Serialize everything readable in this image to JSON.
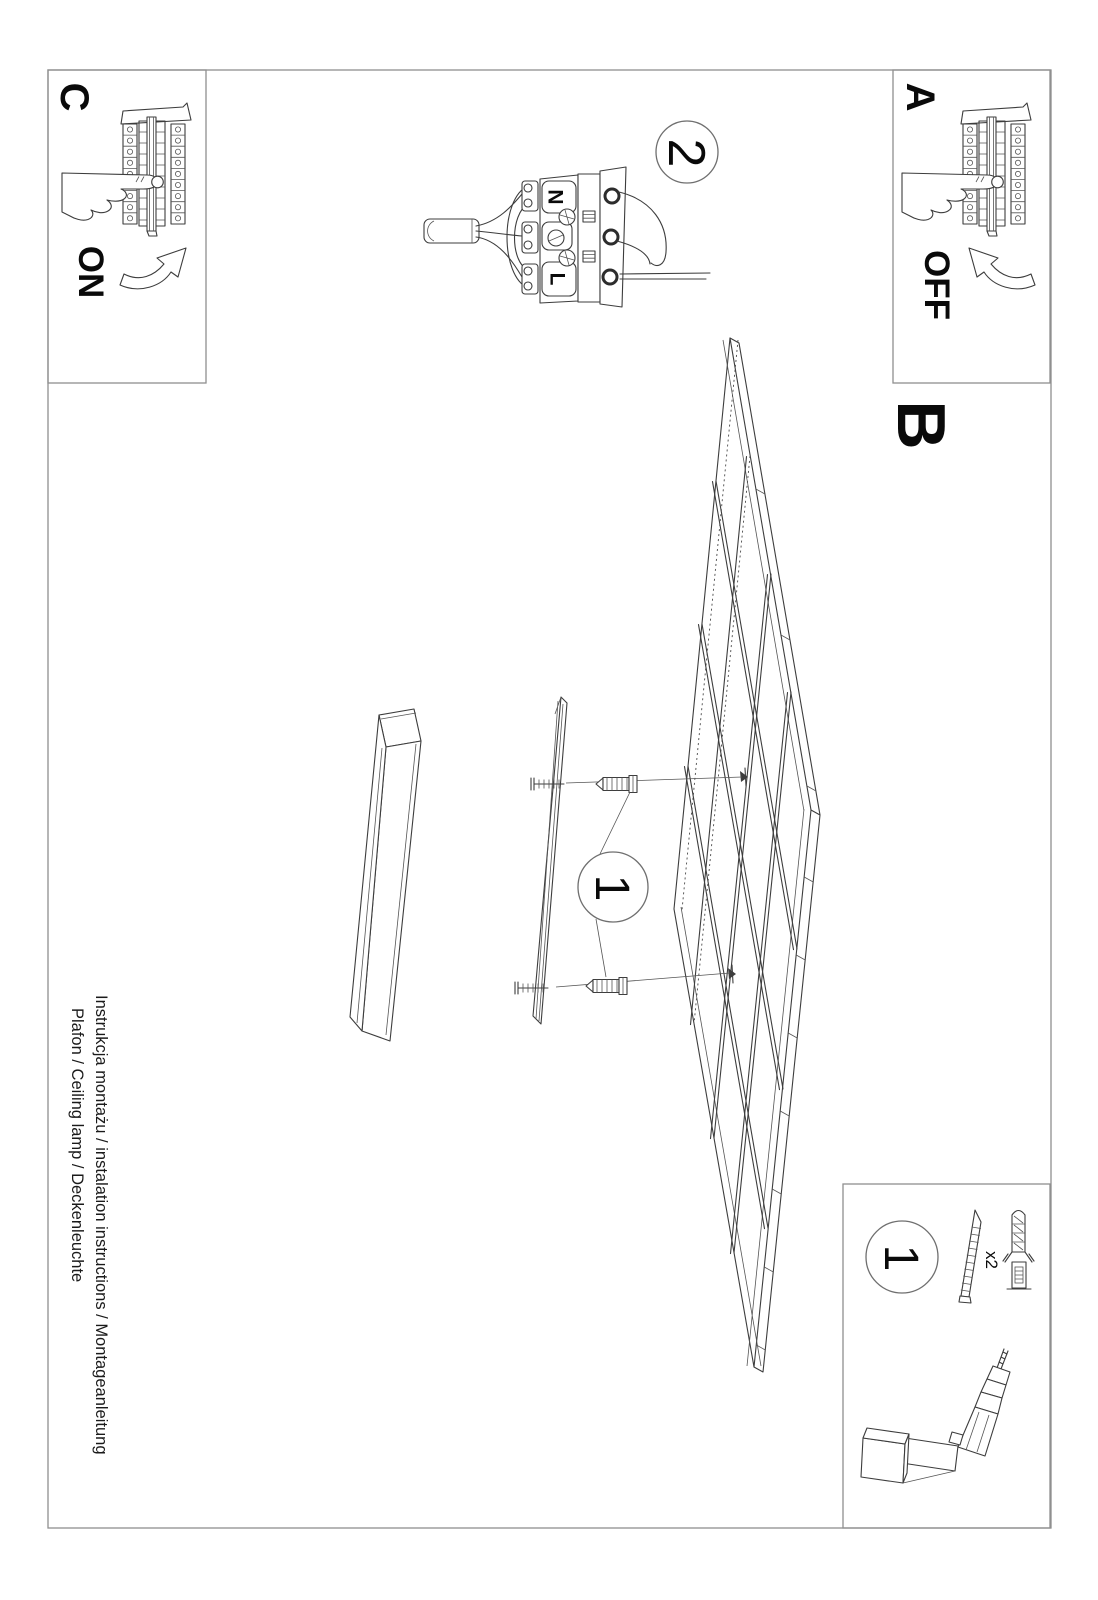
{
  "page": {
    "title_line": "Instrukcja montażu / instalation instructions / Montageanleitung",
    "product_line": "Plafon / Ceiling lamp / Deckenleuchte"
  },
  "panels": {
    "a": {
      "label": "A",
      "action": "OFF"
    },
    "b": {
      "label": "B"
    },
    "c": {
      "label": "C",
      "action": "ON"
    }
  },
  "step1": {
    "badge": "1"
  },
  "step2": {
    "badge": "2",
    "terminal_top": "N",
    "terminal_bottom": "L"
  },
  "toolbox": {
    "badge": "1",
    "quantity": "x2"
  },
  "colors": {
    "ink": "#3d3d3d",
    "frame": "#8f8f8f",
    "text": "#0a0a0a",
    "background": "#ffffff"
  }
}
